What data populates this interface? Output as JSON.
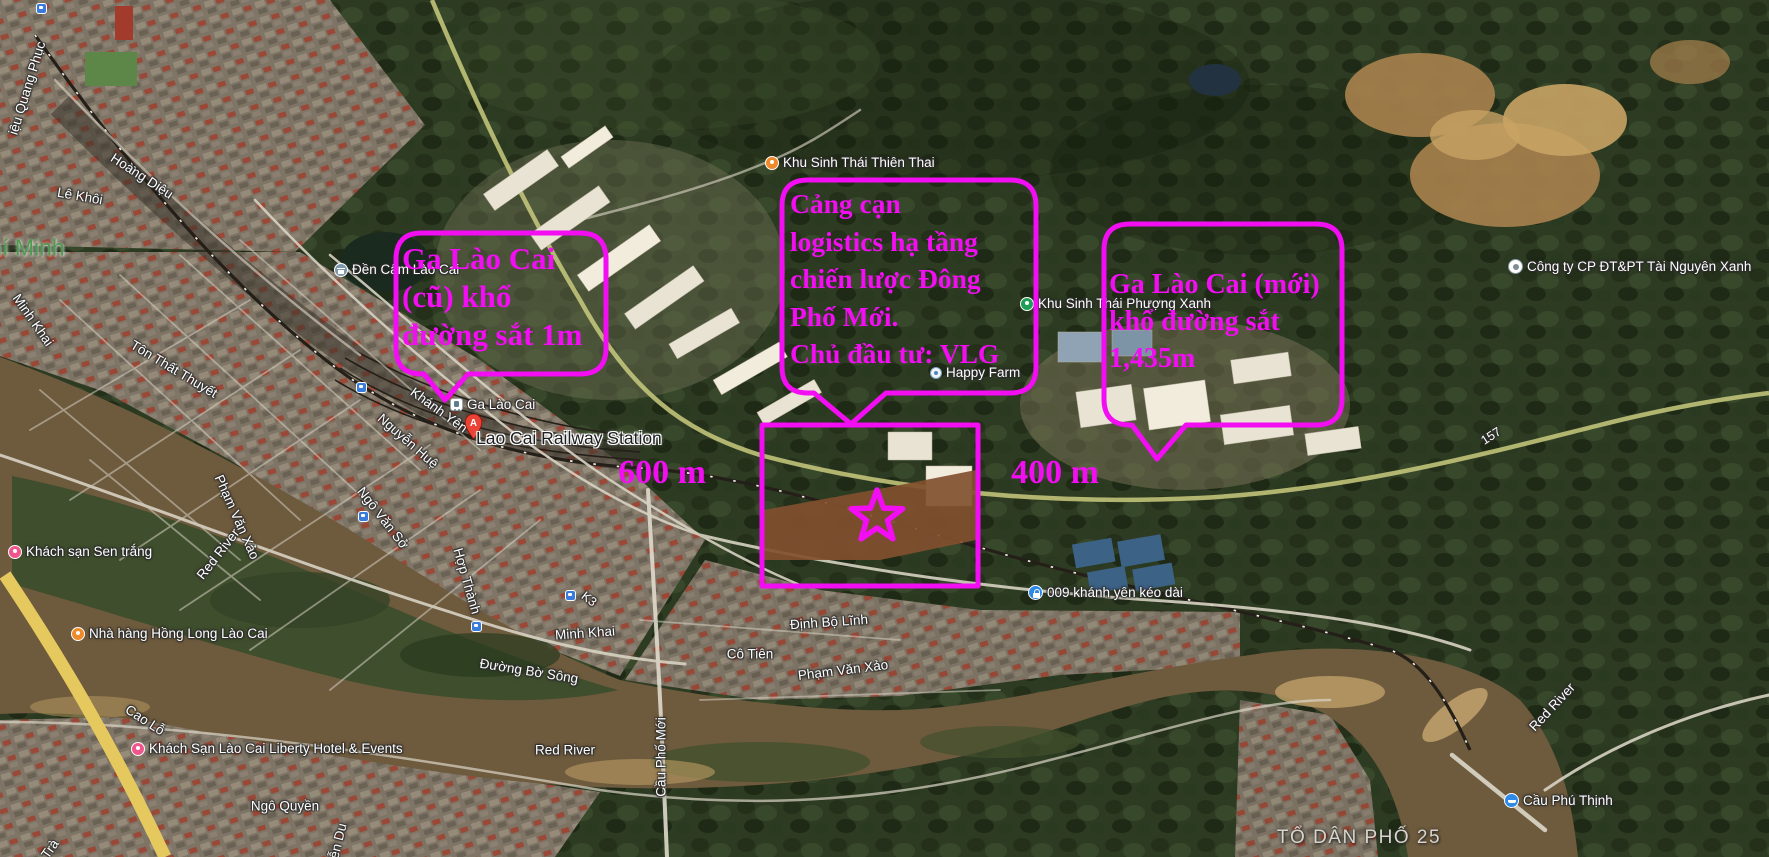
{
  "colors": {
    "annotation": "#f20df2",
    "river": "#6e5a3d",
    "forest": "#2e3b23"
  },
  "annotations": {
    "callout_old_station": {
      "line1": "Ga Lào Cai",
      "line2": "(cũ) khổ",
      "line3": "đường sắt 1m"
    },
    "callout_dry_port": {
      "line1": "Cảng cạn",
      "line2": "logistics hạ tầng",
      "line3": "chiến lược Đông",
      "line4": "Phố Mới.",
      "line5": "Chủ đầu tư: VLG"
    },
    "callout_new_station": {
      "line1": "Ga Lào Cai (mới)",
      "line2": "khổ đường sắt",
      "line3": "1,435m"
    },
    "distance_west": "600 m",
    "distance_east": "400 m"
  },
  "pois": {
    "den_cam": "Đền Cấm Lào Cai",
    "ga_lao_cai": "Ga Lào Cai",
    "railway_station": "Lao Cai Railway Station",
    "pin_letter": "A",
    "thien_thai": "Khu Sinh Thái Thiên Thai",
    "phuong_xanh": "Khu Sinh Thái Phượng Xanh",
    "happy_farm": "Happy Farm",
    "cong_ty": "Công ty CP ĐT&PT Tài Nguyên Xanh",
    "sen_trang": "Khách sạn Sen trắng",
    "hong_long": "Nhà hàng Hồng Long Lào Cai",
    "liberty": "Khách Sạn Lào Cai Liberty Hotel & Events",
    "cau_phu_thinh": "Cầu Phú Thịnh",
    "khanh_yen_009": "009 khánh yên kéo dài"
  },
  "streets": {
    "trieu_quang_phuc": "iệu Quang Phục",
    "hoang_dieu": "Hoàng Diệu",
    "le_khoi": "Lê Khôi",
    "minh_khai_1": "Minh Khai",
    "ton_that_thuyet": "Tôn Thất Thuyết",
    "khanh_yen": "Khánh Yên",
    "nguyen_hue": "Nguyễn Huệ",
    "ngo_van_so": "Ngô Văn Sở",
    "hop_thanh": "Hợp Thành",
    "k3": "K3",
    "minh_khai_2": "Minh Khai",
    "duong_bo_song": "Đường Bờ Sông",
    "pham_van_xao_1": "Phạm Văn Xảo",
    "pham_van_xao_2": "Phạm Văn Xảo",
    "dinh_bo_linh": "Định Bộ Lĩnh",
    "co_tien": "Cô Tiên",
    "cau_pho_moi": "Cầu Phố Mới",
    "cao_lo": "Cao Lỗ",
    "ngo_quyen": "Ngô Quyền",
    "nguyen_du": "ễn Du",
    "tran": "Trà",
    "route_157": "157"
  },
  "water": {
    "red_river_1": "Red River",
    "red_river_2": "Red River",
    "red_river_3": "Red River"
  },
  "areas": {
    "ho_chi_minh": "hí Minh",
    "to_dan_pho": "TỔ DÂN PHỐ 25"
  }
}
